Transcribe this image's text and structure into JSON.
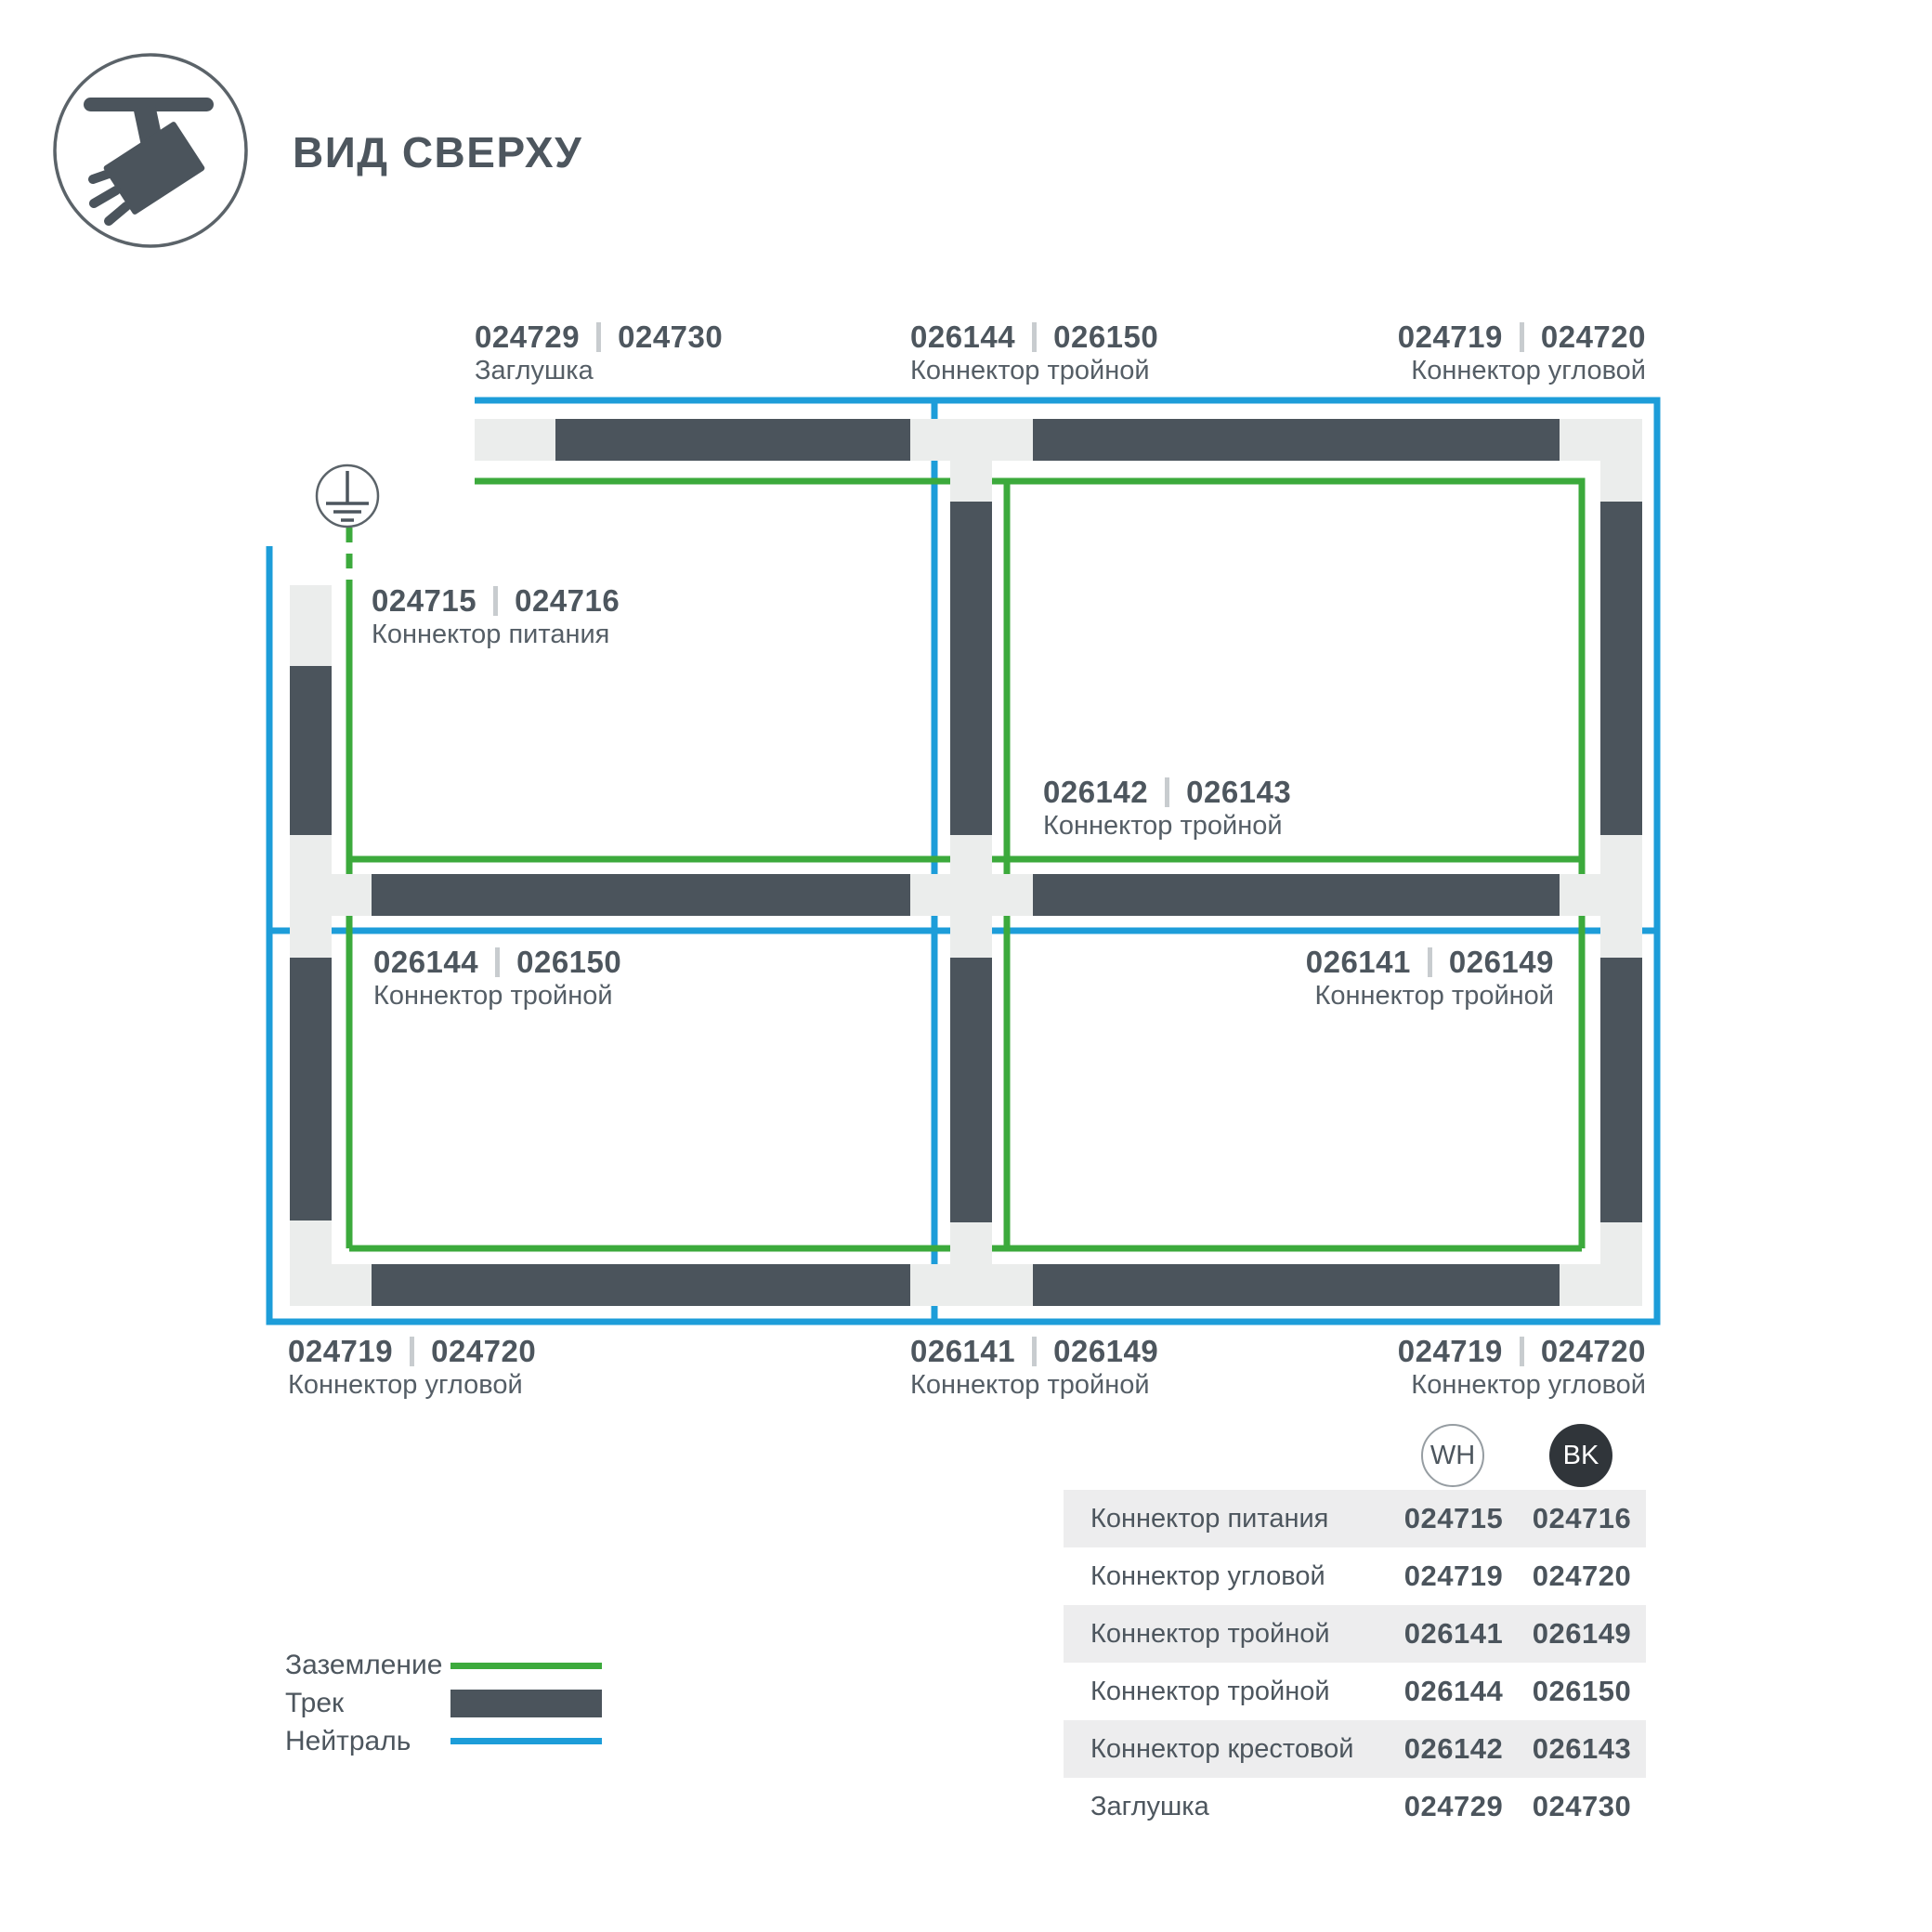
{
  "title": "ВИД СВЕРХУ",
  "colors": {
    "track": "#4b545c",
    "connector_block": "#ebedec",
    "ground_line": "#3caa3c",
    "neutral_line": "#1d9dd9",
    "text": "#4d565e",
    "table_stripe": "#ededee",
    "bk_badge": "#30353a"
  },
  "icon": {
    "name": "track-spotlight-top-view-icon"
  },
  "diagram": {
    "labels": [
      {
        "code_wh": "024729",
        "code_bk": "024730",
        "name": "Заглушка"
      },
      {
        "code_wh": "026144",
        "code_bk": "026150",
        "name": "Коннектор тройной"
      },
      {
        "code_wh": "024719",
        "code_bk": "024720",
        "name": "Коннектор угловой"
      },
      {
        "code_wh": "024715",
        "code_bk": "024716",
        "name": "Коннектор питания"
      },
      {
        "code_wh": "026142",
        "code_bk": "026143",
        "name": "Коннектор тройной"
      },
      {
        "code_wh": "026144",
        "code_bk": "026150",
        "name": "Коннектор тройной"
      },
      {
        "code_wh": "026141",
        "code_bk": "026149",
        "name": "Коннектор тройной"
      },
      {
        "code_wh": "024719",
        "code_bk": "024720",
        "name": "Коннектор угловой"
      },
      {
        "code_wh": "026141",
        "code_bk": "026149",
        "name": "Коннектор тройной"
      },
      {
        "code_wh": "024719",
        "code_bk": "024720",
        "name": "Коннектор угловой"
      }
    ],
    "ground_symbol": "earth-ground-icon"
  },
  "legend": {
    "items": [
      {
        "label": "Заземление",
        "swatch": "green-line"
      },
      {
        "label": "Трек",
        "swatch": "dark-bar"
      },
      {
        "label": "Нейтраль",
        "swatch": "blue-line"
      }
    ]
  },
  "table": {
    "headers": {
      "wh": "WH",
      "bk": "BK"
    },
    "rows": [
      {
        "name": "Коннектор питания",
        "wh": "024715",
        "bk": "024716"
      },
      {
        "name": "Коннектор угловой",
        "wh": "024719",
        "bk": "024720"
      },
      {
        "name": "Коннектор тройной",
        "wh": "026141",
        "bk": "026149"
      },
      {
        "name": "Коннектор тройной",
        "wh": "026144",
        "bk": "026150"
      },
      {
        "name": "Коннектор крестовой",
        "wh": "026142",
        "bk": "026143"
      },
      {
        "name": "Заглушка",
        "wh": "024729",
        "bk": "024730"
      }
    ]
  }
}
